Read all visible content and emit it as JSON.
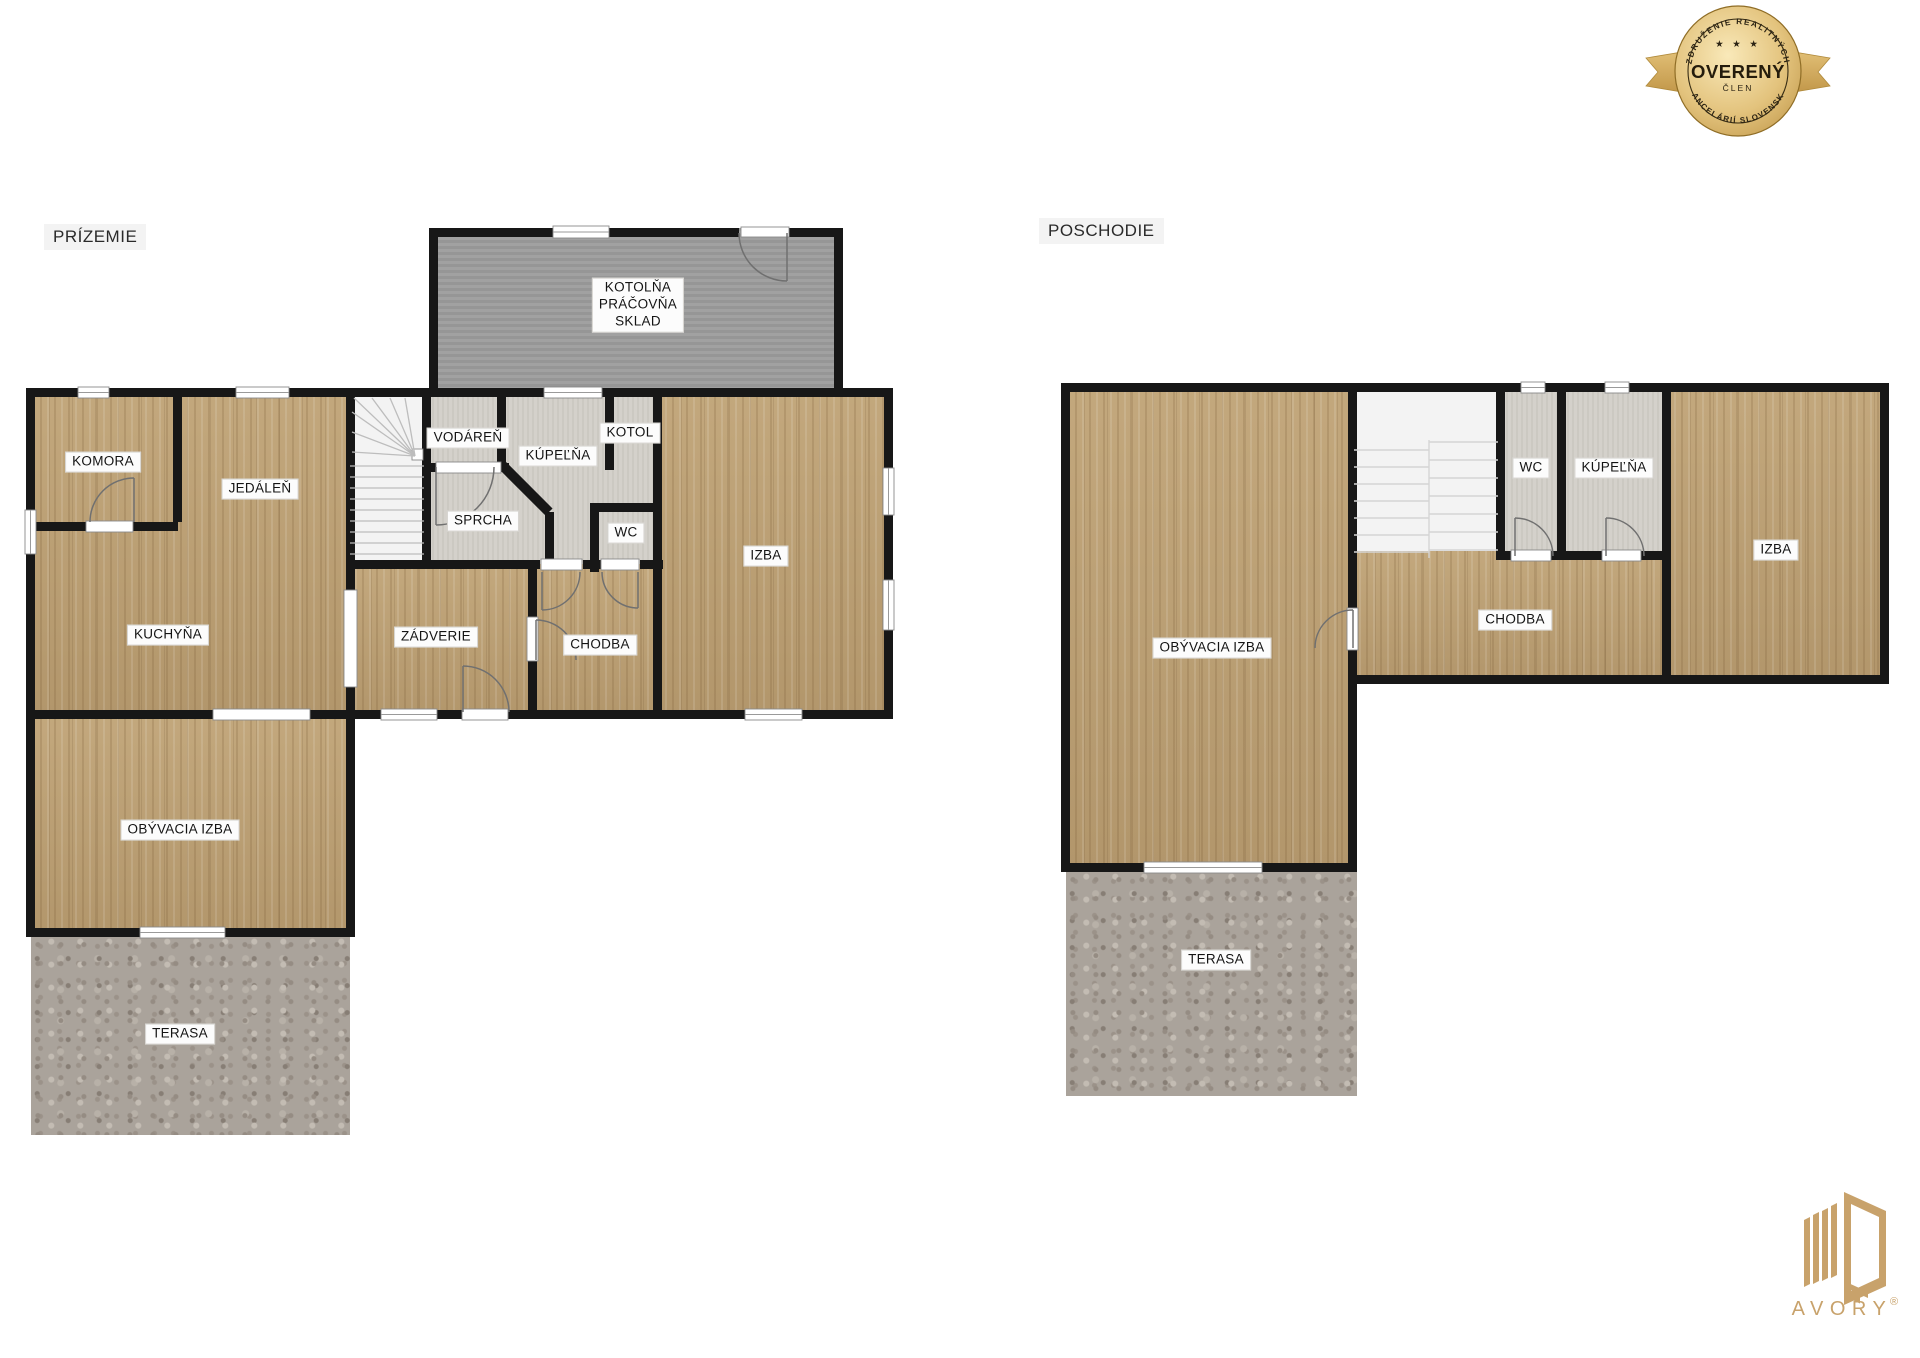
{
  "ground": {
    "title": "PRÍZEMIE",
    "rooms": {
      "komora": "KOMORA",
      "jedalen": "JEDÁLEŇ",
      "kuchyna": "KUCHYŇA",
      "obyvacia_izba": "OBÝVACIA IZBA",
      "terasa": "TERASA",
      "zadverie": "ZÁDVERIE",
      "chodba": "CHODBA",
      "sprcha": "SPRCHA",
      "vodaren": "VODÁREŇ",
      "kupelna": "KÚPEĽŇA",
      "wc": "WC",
      "kotol": "KOTOL",
      "izba": "IZBA",
      "kotolna": "KOTOLŇA\nPRÁČOVŇA\nSKLAD"
    }
  },
  "upper": {
    "title": "POSCHODIE",
    "rooms": {
      "obyvacia_izba": "OBÝVACIA IZBA",
      "chodba": "CHODBA",
      "wc": "WC",
      "kupelna": "KÚPEĽŇA",
      "izba": "IZBA",
      "terasa": "TERASA"
    }
  },
  "badge": {
    "arc_top": "ZDRUŽENIE REALITNÝCH",
    "stars": "★ ★ ★",
    "title": "OVERENÝ",
    "subtitle": "ČLEN",
    "arc_bottom": "KANCELÁRIÍ SLOVENSKA"
  },
  "logo": {
    "brand": "AVORY",
    "registered": "®"
  },
  "colors": {
    "wall": "#171717",
    "wood": "#bda077",
    "utility_gray": "#9c9c9c",
    "bath_gray": "#d2cfc8",
    "stairs": "#f3f3f3",
    "terrace": "#aaa39b",
    "badge_gold": "#d3ab60",
    "logo_gold": "#c8a26b"
  }
}
